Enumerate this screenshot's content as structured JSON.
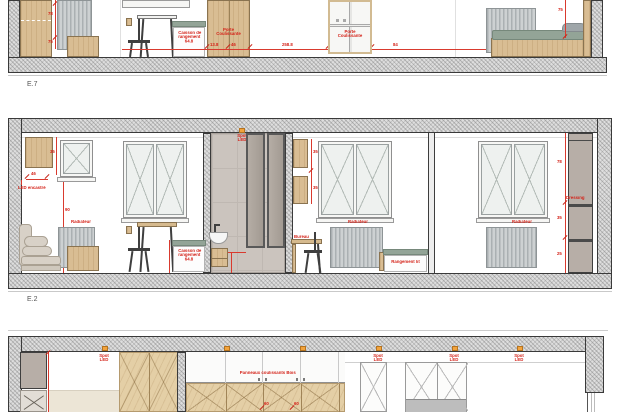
{
  "title": "Apartment interior elevation drawings",
  "colors": {
    "annotation_red": "#d42218",
    "spot_orange": "#f2a33c",
    "wood": "#d9bd93",
    "light_wood": "#e4cfa6",
    "mattress_green": "#93a497",
    "wall_hatch_gray": "#dedede",
    "tile_taupe": "#cbc4be",
    "dressing_taupe": "#b7aea7",
    "radiator_gray": "#cdd1d2"
  },
  "labels": {
    "e7": "E.7",
    "e2": "E.2",
    "led": "LED encastré",
    "caisson1": "Caisson de",
    "caisson2": "rangement",
    "caisson3": "64.8",
    "porte1": "Porte",
    "porte2": "Coulissante",
    "radiateur": "Radiateur",
    "bureau": "Bureau",
    "rangement": "Rangement lit",
    "dressing": "Dressing",
    "spot1": "Spot",
    "spot2": "LED",
    "panneaux": "Panneaux coulissants Bois"
  },
  "dims": {
    "e7_h1": "13.8",
    "e7_h2": "46",
    "e7_h3": "258.8",
    "e7_h4": "84",
    "e7_v1": "78",
    "e7_v2": "75",
    "e7_v3": "75",
    "e2_cab_w": "46",
    "e2_cab_h": "35",
    "e2_win": "90",
    "e2_shelf1": "35",
    "e2_shelf2": "35",
    "e2_dr1": "78",
    "e2_dr2": "35",
    "e2_dr3": "25",
    "b1": "60",
    "b2": "60"
  }
}
